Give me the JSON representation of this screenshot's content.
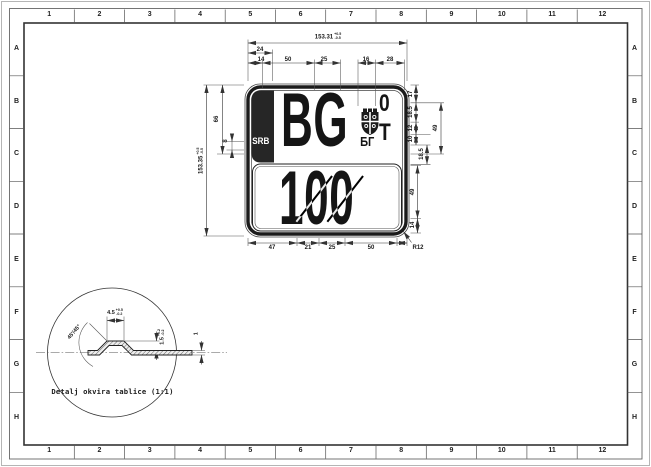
{
  "sheet": {
    "cols": [
      "1",
      "2",
      "3",
      "4",
      "5",
      "6",
      "7",
      "8",
      "9",
      "10",
      "11",
      "12"
    ],
    "rows": [
      "A",
      "B",
      "C",
      "D",
      "E",
      "F",
      "G",
      "H"
    ]
  },
  "plate": {
    "country": "SRB",
    "code": "BG",
    "code_cyrillic": "БГ",
    "digit_zero": "0",
    "letter_t": "T",
    "number": "100",
    "emblem": "serbian-cross-shield",
    "band_color": "#262626",
    "line_color": "#1b1b1b"
  },
  "dims": {
    "overall_width": "153.31",
    "overall_width_tol_up": "+0.5",
    "overall_width_tol_dn": "-0.5",
    "overall_height": "153.35",
    "overall_height_tol_up": "+0.5",
    "overall_height_tol_dn": "-0.5",
    "top_24": "24",
    "top_14": "14",
    "top_50": "50",
    "top_25": "25",
    "top_16": "16",
    "top_28": "28",
    "left_66": "66",
    "left_8": "8",
    "right_17": "17",
    "right_18_5_a": "18.5",
    "right_12": "12",
    "right_10": "10",
    "right_18_5_b": "18.5",
    "right_49_a": "49",
    "right_49_b": "49",
    "right_14": "14",
    "bottom_47": "47",
    "bottom_21": "21",
    "bottom_25": "25",
    "bottom_50": "50",
    "corner_radius": "R12"
  },
  "detail": {
    "caption": "Detalj okvira tablice (1:1)",
    "angle": "45'/45°",
    "flat_width": "4.5",
    "flat_width_tol_up": "+0.5",
    "flat_width_tol_dn": "-0.2",
    "rib_height": "1.5",
    "rib_height_tol_up": "+0.2",
    "rib_height_tol_dn": "-0.2",
    "thickness": "1"
  }
}
